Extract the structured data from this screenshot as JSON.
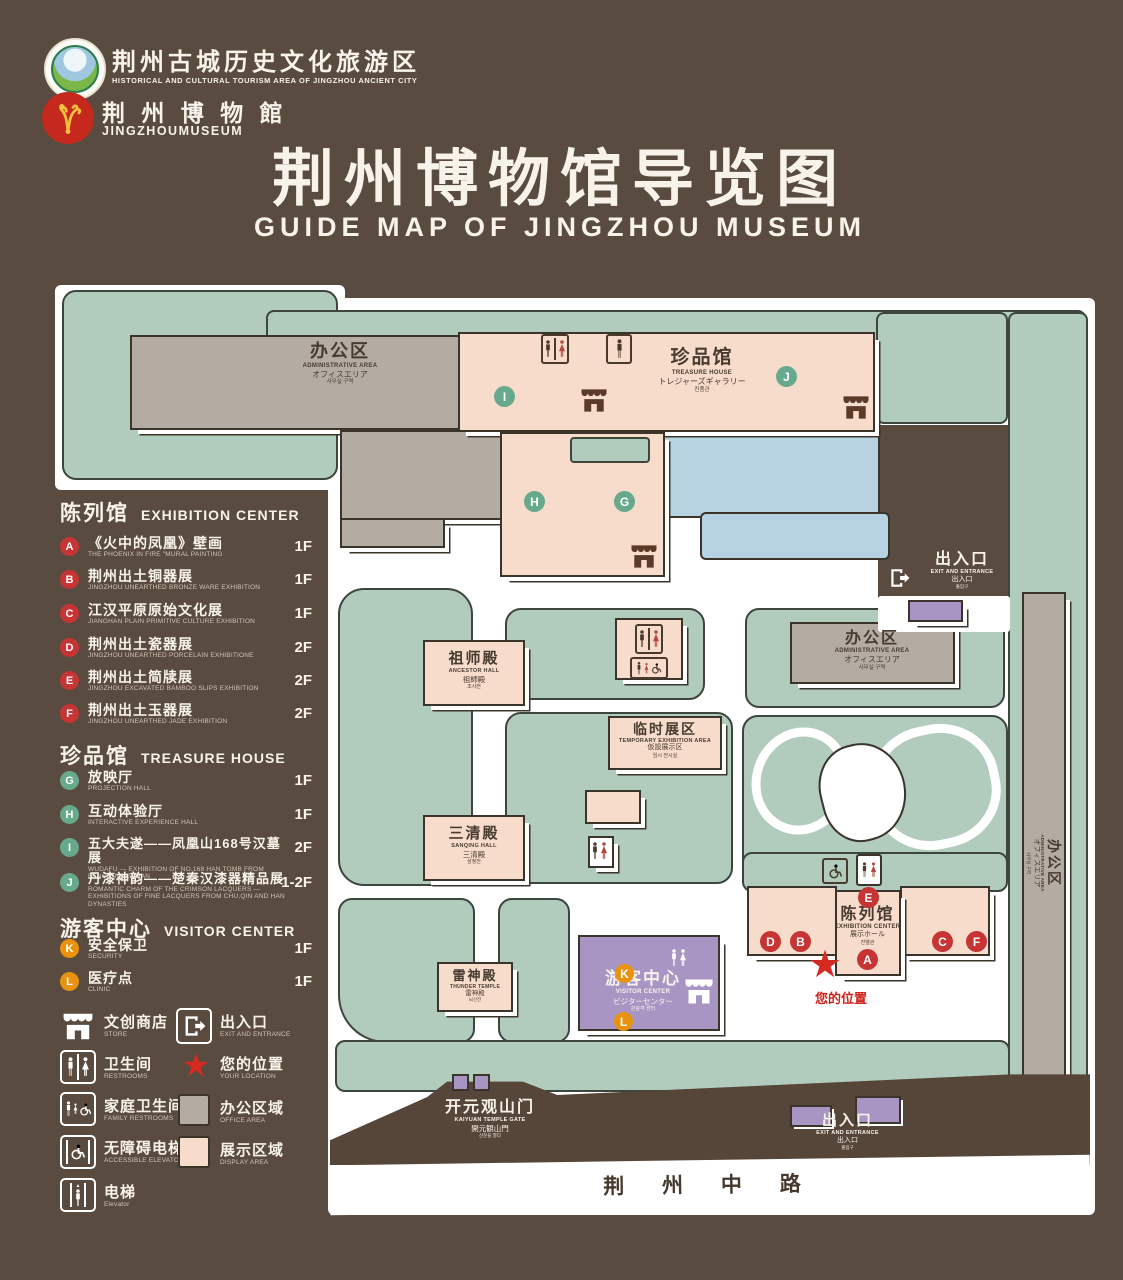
{
  "header": {
    "org": {
      "cn": "荆州古城历史文化旅游区",
      "en": "HISTORICAL AND CULTURAL TOURISM AREA OF JINGZHOU ANCIENT CITY"
    },
    "museum": {
      "cn": "荆 州 博 物 館",
      "en": "JINGZHOUMUSEUM"
    },
    "title_cn": "荆州博物馆导览图",
    "title_en": "GUIDE MAP OF JINGZHOU MUSEUM"
  },
  "icons": {
    "star": "★",
    "up": "▲",
    "down": "▼"
  },
  "markers": {
    "A": "A",
    "B": "B",
    "C": "C",
    "D": "D",
    "E": "E",
    "F": "F",
    "G": "G",
    "H": "H",
    "I": "I",
    "J": "J",
    "K": "K",
    "L": "L"
  },
  "legend": {
    "exhibition": {
      "title_cn": "陈列馆",
      "title_en": "EXHIBITION CENTER",
      "items": [
        {
          "key": "A",
          "cn": "《火中的凤凰》壁画",
          "en": "THE PHOENIX IN FIRE \"MURAL PAINTING",
          "floor": "1F"
        },
        {
          "key": "B",
          "cn": "荆州出土铜器展",
          "en": "JINGZHOU UNEARTHED BRONZE WARE EXHIBITION",
          "floor": "1F"
        },
        {
          "key": "C",
          "cn": "江汉平原原始文化展",
          "en": "JIANGHAN PLAIN PRIMITIVE CULTURE EXHIBITION",
          "floor": "1F"
        },
        {
          "key": "D",
          "cn": "荆州出土瓷器展",
          "en": "JINGZHOU UNEARTHED PORCELAIN EXHIBITIONE",
          "floor": "2F"
        },
        {
          "key": "E",
          "cn": "荆州出土简牍展",
          "en": "JINGZHOU EXCAVATED BAMBOO SLIPS EXHIBITION",
          "floor": "2F"
        },
        {
          "key": "F",
          "cn": "荆州出土玉器展",
          "en": "JINGZHOU UNEARTHED JADE EXHIBITION",
          "floor": "2F"
        }
      ]
    },
    "treasure": {
      "title_cn": "珍品馆",
      "title_en": "TREASURE HOUSE",
      "items": [
        {
          "key": "G",
          "cn": "放映厅",
          "en": "PROJECTION HALL",
          "floor": "1F"
        },
        {
          "key": "H",
          "cn": "互动体验厅",
          "en": "INTERACTIVE EXPERIENCE HALL",
          "floor": "1F"
        },
        {
          "key": "I",
          "cn": "五大夫遂——凤凰山168号汉墓展",
          "en": "WUDAFU — EXHIBITION OF NO.168 HAN TOMB FROM FENGHUANGSHAN",
          "floor": "2F"
        },
        {
          "key": "J",
          "cn": "丹漆神韵——楚秦汉漆器精品展",
          "en": "ROMANTIC CHARM OF THE CRIMSON LACQUERS — EXHIBITIONS OF FINE LACQUERS FROM CHU,QIN AND HAN DYNASTIES",
          "floor": "1-2F"
        }
      ]
    },
    "visitor": {
      "title_cn": "游客中心",
      "title_en": "VISITOR CENTER",
      "items": [
        {
          "key": "K",
          "cn": "安全保卫",
          "en": "SECURITY",
          "floor": "1F"
        },
        {
          "key": "L",
          "cn": "医疗点",
          "en": "CLINIC",
          "floor": "1F"
        }
      ]
    },
    "symbols": [
      {
        "cn": "文创商店",
        "en": "STORE"
      },
      {
        "cn": "出入口",
        "en": "EXIT AND ENTRANCE"
      },
      {
        "cn": "卫生间",
        "en": "RESTROOMS"
      },
      {
        "cn": "您的位置",
        "en": "YOUR LOCATION"
      },
      {
        "cn": "家庭卫生间",
        "en": "FAMILY RESTROOMS"
      },
      {
        "cn": "办公区域",
        "en": "OFFICE AREA"
      },
      {
        "cn": "无障碍电梯",
        "en": "ACCESSIBLE ELEVATOR"
      },
      {
        "cn": "展示区域",
        "en": "DISPLAY AREA"
      },
      {
        "cn": "电梯",
        "en": "Elevator"
      }
    ]
  },
  "map": {
    "admin_nw": {
      "cn": "办公区",
      "en": "ADMINISTRATIVE AREA",
      "ja": "オフィスエリア",
      "ko": "사무실 구역"
    },
    "admin_e": {
      "cn": "办公区",
      "en": "ADMINISTRATIVE AREA",
      "ja": "オフィスエリア",
      "ko": "사무실 구역"
    },
    "admin_strip": {
      "cn": "办公区",
      "en": "ADMINISTRATIVE AREA",
      "ja": "オフィスエリア",
      "ko": "사무실 구역"
    },
    "treasure_house": {
      "cn": "珍品馆",
      "en": "TREASURE HOUSE",
      "ja": "トレジャーズギャラリー",
      "ko": "진품관"
    },
    "ancestor_hall": {
      "cn": "祖师殿",
      "en": "ANCESTOR HALL",
      "ja": "祖師殿",
      "ko": "조사전"
    },
    "temp_exhibition": {
      "cn": "临时展区",
      "en": "TEMPORARY EXHIBITION AREA",
      "ja": "仮設展示区",
      "ko": "임시 전시실"
    },
    "sanqing_hall": {
      "cn": "三清殿",
      "en": "SANQING HALL",
      "ja": "三清殿",
      "ko": "삼청전"
    },
    "thunder_temple": {
      "cn": "雷神殿",
      "en": "THUNDER TEMPLE",
      "ja": "雷神殿",
      "ko": "뇌신전"
    },
    "visitor_center": {
      "cn": "游客中心",
      "en": "VISITOR CENTER",
      "ja": "ビジターセンター",
      "ko": "관광객 센터"
    },
    "exhibition_center": {
      "cn": "陈列馆",
      "en": "EXHIBITION CENTER",
      "ja": "展示ホール",
      "ko": "진열관"
    },
    "exit_ne": {
      "cn": "出入口",
      "en": "EXIT AND ENTRANCE",
      "ja": "出入口",
      "ko": "출입구"
    },
    "exit_s": {
      "cn": "出入口",
      "en": "EXIT AND ENTRANCE",
      "ja": "出入口",
      "ko": "출입구"
    },
    "gate": {
      "cn": "开元观山门",
      "en": "KAIYUAN TEMPLE GATE",
      "ja": "開元観山門",
      "ko": "산문을 열다"
    },
    "your_location": {
      "cn": "您的位置"
    },
    "road": {
      "cn": "荆 州 中 路"
    }
  },
  "colors": {
    "background": "#5a4b40",
    "park_green": "#b1cbbc",
    "display_pink": "#f8dccb",
    "office_gray": "#b4aca3",
    "visitor_purple": "#a995c4",
    "water_blue": "#b7d3e2",
    "marker_red": "#c63434",
    "marker_green": "#67a98c",
    "marker_orange": "#e8920e",
    "location_star": "#d42a20",
    "title_text": "#f7f3ea"
  }
}
